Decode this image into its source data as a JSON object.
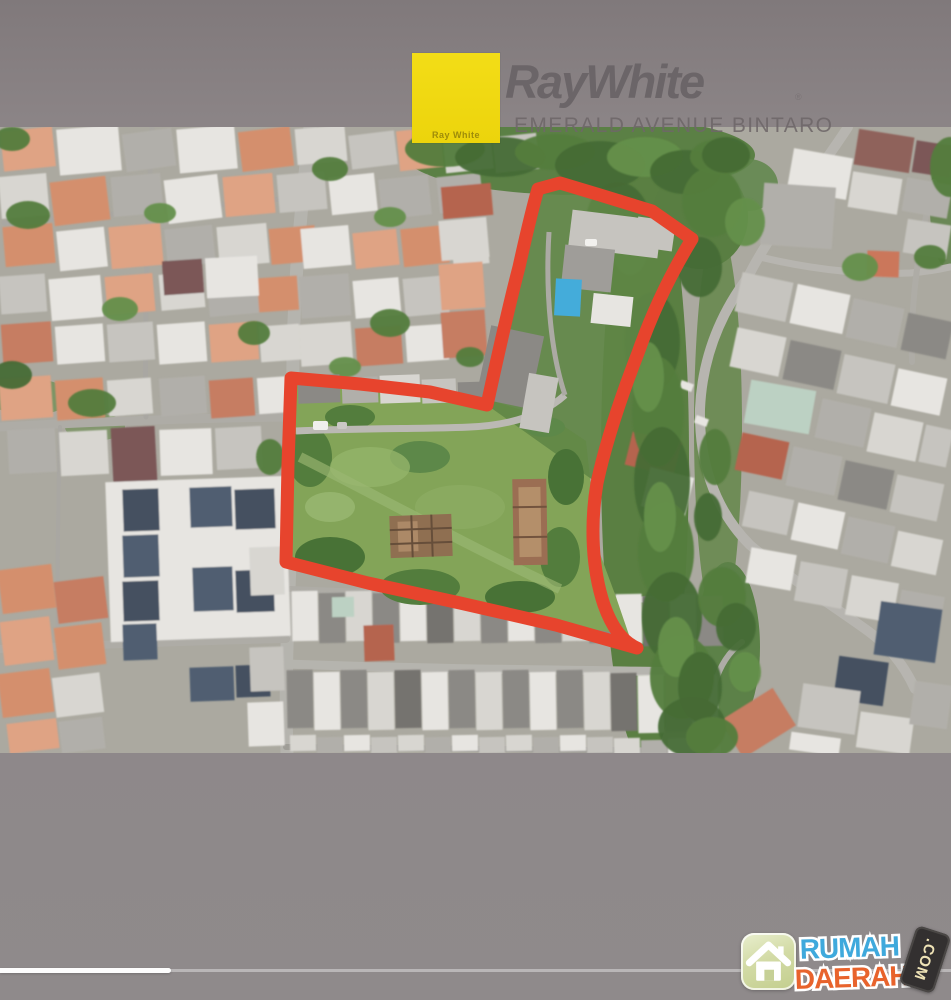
{
  "header": {
    "brand": "RayWhite",
    "trademark": "®",
    "logo_box_caption": "Ray White",
    "subtitle": "EMERALD AVENUE BINTARO"
  },
  "watermark": {
    "word1": "RUMAH",
    "word2": "DAERAH",
    "badge": ".COM"
  },
  "player": {
    "progress_percent": 18
  },
  "colors": {
    "brand_yellow": "#F1D90E",
    "brand_text": "#6B6568",
    "subtitle_text": "#6E6769",
    "boundary_red": "#E63A22",
    "watermark_blue": "#3FA9DC",
    "watermark_orange": "#E8632C",
    "badge_dark": "#333030",
    "frame_gray": "#8F8A8B",
    "footer_gray": "#908C8D"
  }
}
